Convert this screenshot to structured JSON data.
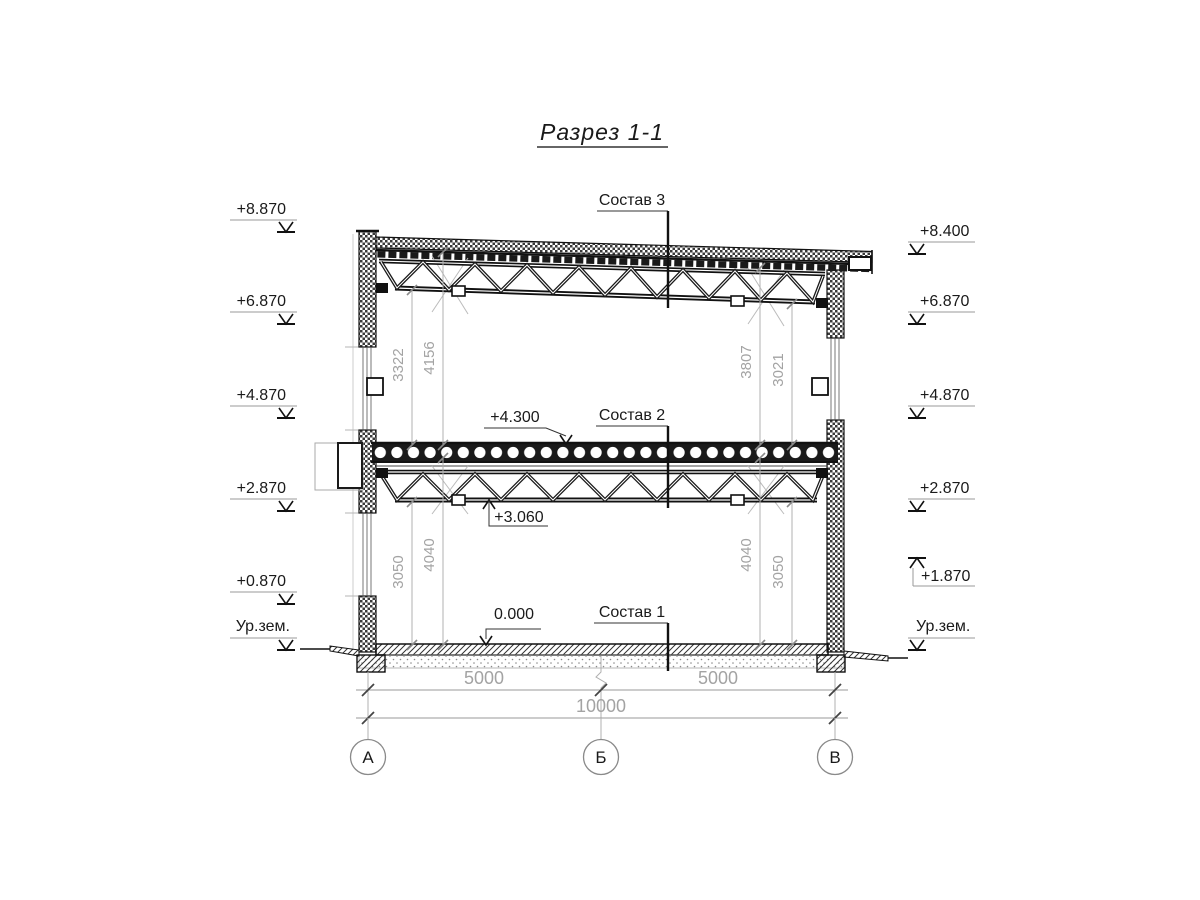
{
  "title": "Разрез 1-1",
  "colors": {
    "ink": "#1a1a1a",
    "dim_gray": "#a3a3a3",
    "light_gray": "#bbbbbb",
    "background": "#ffffff"
  },
  "assembly_labels": {
    "sostav3": "Состав 3",
    "sostav2": "Состав 2",
    "sostav1": "Состав 1"
  },
  "level_labels": {
    "slab_top": "+4.300",
    "truss_bottom": "+3.060",
    "floor": "0.000"
  },
  "left_marks": [
    {
      "label": "+8.870"
    },
    {
      "label": "+6.870"
    },
    {
      "label": "+4.870"
    },
    {
      "label": "+2.870"
    },
    {
      "label": "+0.870"
    },
    {
      "label": "Ур.зем."
    }
  ],
  "right_marks": [
    {
      "label": "+8.400"
    },
    {
      "label": "+6.870"
    },
    {
      "label": "+4.870"
    },
    {
      "label": "+2.870"
    },
    {
      "label": "+1.870"
    },
    {
      "label": "Ур.зем."
    }
  ],
  "vertical_dims": {
    "left_upper": [
      "3322",
      "4156"
    ],
    "right_upper": [
      "3807",
      "3021"
    ],
    "left_lower": [
      "3050",
      "4040"
    ],
    "right_lower": [
      "4040",
      "3050"
    ]
  },
  "horizontal_dims": {
    "span_left": "5000",
    "span_right": "5000",
    "total": "10000"
  },
  "axes": [
    {
      "label": "А"
    },
    {
      "label": "Б"
    },
    {
      "label": "В"
    }
  ]
}
